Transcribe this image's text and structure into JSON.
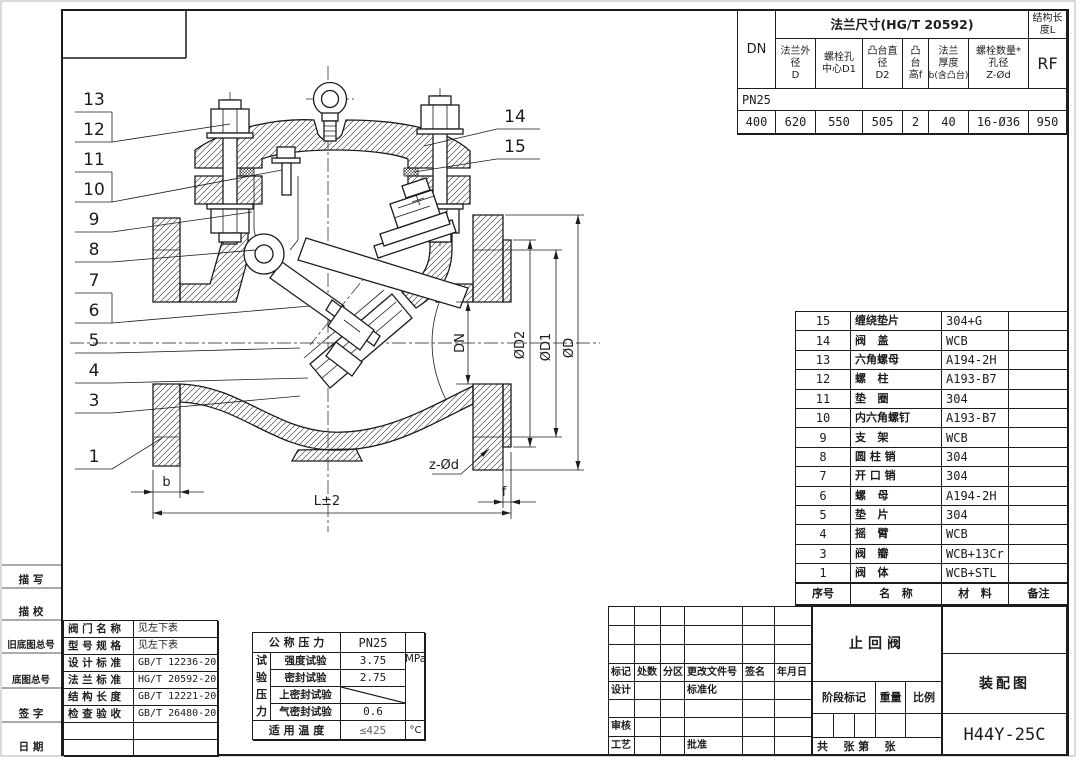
{
  "flange_table": {
    "dn": "DN",
    "title": "法兰尺寸(HG/T 20592)",
    "struct_len": {
      "l1": "结构长",
      "l2": "度L"
    },
    "rf": "RF",
    "headers": [
      {
        "l1": "法兰外",
        "l2": "径",
        "l3": "D"
      },
      {
        "l1": "螺栓孔",
        "l2": "中心D1",
        "l3": ""
      },
      {
        "l1": "凸台直",
        "l2": "径",
        "l3": "D2"
      },
      {
        "l1": "凸",
        "l2": "台",
        "l3": "高f"
      },
      {
        "l1": "法兰",
        "l2": "厚度",
        "l3": "b(含凸台)"
      },
      {
        "l1": "螺栓数量*",
        "l2": "孔径",
        "l3": "Z-Ød"
      }
    ],
    "pn": "PN25",
    "values": [
      "400",
      "620",
      "550",
      "505",
      "2",
      "40",
      "16-Ø36",
      "950"
    ]
  },
  "parts_table": {
    "rows": [
      {
        "no": "15",
        "name": "缠绕垫片",
        "material": "304+G",
        "note": ""
      },
      {
        "no": "14",
        "name": "阀   盖",
        "material": "WCB",
        "note": ""
      },
      {
        "no": "13",
        "name": "六角螺母",
        "material": "A194-2H",
        "note": ""
      },
      {
        "no": "12",
        "name": "螺   柱",
        "material": "A193-B7",
        "note": ""
      },
      {
        "no": "11",
        "name": "垫   圈",
        "material": "304",
        "note": ""
      },
      {
        "no": "10",
        "name": "内六角螺钉",
        "material": "A193-B7",
        "note": ""
      },
      {
        "no": "9",
        "name": "支   架",
        "material": "WCB",
        "note": ""
      },
      {
        "no": "8",
        "name": "圆 柱 销",
        "material": "304",
        "note": ""
      },
      {
        "no": "7",
        "name": "开 口 销",
        "material": "304",
        "note": ""
      },
      {
        "no": "6",
        "name": "螺   母",
        "material": "A194-2H",
        "note": ""
      },
      {
        "no": "5",
        "name": "垫   片",
        "material": "304",
        "note": ""
      },
      {
        "no": "4",
        "name": "摇   臂",
        "material": "WCB",
        "note": ""
      },
      {
        "no": "3",
        "name": "阀   瓣",
        "material": "WCB+13Cr",
        "note": ""
      },
      {
        "no": "1",
        "name": "阀   体",
        "material": "WCB+STL",
        "note": ""
      }
    ],
    "footer": {
      "no": "序号",
      "name": "名   称",
      "material": "材   料",
      "note": "备注"
    }
  },
  "info_table": {
    "rows": [
      {
        "label": "阀 门 名 称",
        "value": "见左下表"
      },
      {
        "label": "型 号 规 格",
        "value": "见左下表"
      },
      {
        "label": "设 计 标 准",
        "value": "GB/T 12236-2007"
      },
      {
        "label": "法 兰 标 准",
        "value": "HG/T 20592-2009"
      },
      {
        "label": "结 构 长 度",
        "value": "GB/T 12221-2005"
      },
      {
        "label": "检 查 验 收",
        "value": "GB/T 26480-2011"
      },
      {
        "label": "",
        "value": ""
      },
      {
        "label": "",
        "value": ""
      }
    ]
  },
  "pressure_table": {
    "nominal_label": "公 称 压 力",
    "nominal_value": "PN25",
    "group_chars": [
      "试",
      "验",
      "压",
      "力"
    ],
    "rows": [
      {
        "label": "强度试验",
        "value": "3.75"
      },
      {
        "label": "密封试验",
        "value": "2.75"
      },
      {
        "label": "上密封试验",
        "value": ""
      },
      {
        "label": "气密封试验",
        "value": "0.6"
      }
    ],
    "unit": "MPa",
    "temp_label": "适 用 温 度",
    "temp_value": "≤425",
    "temp_unit": "°C"
  },
  "margin_labels": [
    "描  写",
    "描  校",
    "旧底图总号",
    "底图总号",
    "签  字",
    "日  期"
  ],
  "title_block": {
    "rev_cells": [
      "",
      "",
      "",
      "",
      "",
      "",
      "",
      "",
      "",
      "",
      "",
      "",
      "",
      "",
      "",
      "",
      "",
      "",
      "标记",
      "处数",
      "分区",
      "更改文件号",
      "签名",
      "年月日",
      "设计",
      "",
      "",
      "标准化",
      "",
      "",
      "",
      "",
      "",
      "",
      "",
      "",
      "审核",
      "",
      "",
      "",
      "",
      "",
      "工艺",
      "",
      "",
      "批准",
      "",
      ""
    ],
    "product": "止回阀",
    "stage": "阶段标记",
    "weight": "重量",
    "scale": "比例",
    "sheets": "共    张 第    张",
    "doc_type": "装配图",
    "model": "H44Y-25C"
  },
  "callouts": {
    "left": [
      "13",
      "12",
      "11",
      "10",
      "9",
      "8",
      "7",
      "6",
      "5",
      "4",
      "3",
      "1"
    ],
    "right": [
      "14",
      "15"
    ]
  },
  "dims": {
    "dn": "DN",
    "d2": "ØD2",
    "d1": "ØD1",
    "d": "ØD",
    "zd": "z-Ød",
    "b": "b",
    "l": "L±2",
    "f": "f"
  }
}
